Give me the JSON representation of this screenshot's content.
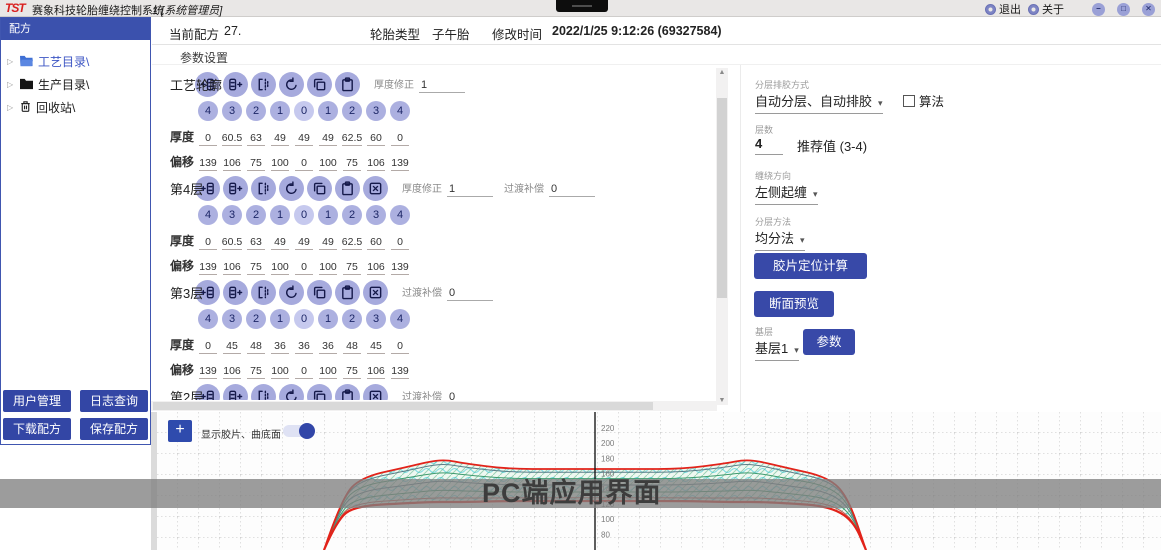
{
  "titlebar": {
    "logo": "TST",
    "title": "赛象科技轮胎缠绕控制系统",
    "subtitle": "1 [系统管理员]",
    "exit_label": "退出",
    "about_label": "关于",
    "minimize": "–",
    "maximize": "□",
    "close": "✕"
  },
  "sidebar": {
    "header": "配方",
    "tree": [
      {
        "label": "工艺目录\\",
        "icon": "folder-open-icon",
        "selected": true
      },
      {
        "label": "生产目录\\",
        "icon": "folder-icon",
        "selected": false
      },
      {
        "label": "回收站\\",
        "icon": "trash-icon",
        "selected": false
      }
    ],
    "buttons": [
      "用户管理",
      "日志查询",
      "下载配方",
      "保存配方"
    ]
  },
  "header": {
    "recipe_label": "当前配方",
    "recipe_value": "27.",
    "tire_type_label": "轮胎类型",
    "tire_type_value": "子午胎",
    "modified_label": "修改时间",
    "modified_value": "2022/1/25 9:12:26 (69327584)"
  },
  "params": {
    "section_title": "参数设置",
    "indices": [
      "4",
      "3",
      "2",
      "1",
      "0",
      "1",
      "2",
      "3",
      "4"
    ],
    "groups": [
      {
        "name": "工艺轮廓",
        "tools": [
          "insert-left",
          "insert-right",
          "mirror",
          "rotate",
          "copy",
          "paste"
        ],
        "fields": [
          {
            "label": "厚度修正",
            "value": "1"
          }
        ],
        "rows": [
          {
            "label": "厚度",
            "values": [
              "0",
              "60.5",
              "63",
              "49",
              "49",
              "49",
              "62.5",
              "60",
              "0"
            ]
          },
          {
            "label": "偏移",
            "values": [
              "139",
              "106",
              "75",
              "100",
              "0",
              "100",
              "75",
              "106",
              "139"
            ]
          }
        ]
      },
      {
        "name": "第4层",
        "tools": [
          "insert-left",
          "insert-right",
          "mirror",
          "rotate",
          "copy",
          "paste",
          "delete"
        ],
        "fields": [
          {
            "label": "厚度修正",
            "value": "1"
          },
          {
            "label": "过渡补偿",
            "value": "0"
          }
        ],
        "rows": [
          {
            "label": "厚度",
            "values": [
              "0",
              "60.5",
              "63",
              "49",
              "49",
              "49",
              "62.5",
              "60",
              "0"
            ]
          },
          {
            "label": "偏移",
            "values": [
              "139",
              "106",
              "75",
              "100",
              "0",
              "100",
              "75",
              "106",
              "139"
            ]
          }
        ]
      },
      {
        "name": "第3层",
        "tools": [
          "insert-left",
          "insert-right",
          "mirror",
          "rotate",
          "copy",
          "paste",
          "delete"
        ],
        "fields": [
          {
            "label": "过渡补偿",
            "value": "0"
          }
        ],
        "rows": [
          {
            "label": "厚度",
            "values": [
              "0",
              "45",
              "48",
              "36",
              "36",
              "36",
              "48",
              "45",
              "0"
            ]
          },
          {
            "label": "偏移",
            "values": [
              "139",
              "106",
              "75",
              "100",
              "0",
              "100",
              "75",
              "106",
              "139"
            ]
          }
        ]
      },
      {
        "name": "第2层",
        "tools": [
          "insert-left",
          "insert-right",
          "mirror",
          "rotate",
          "copy",
          "paste",
          "delete"
        ],
        "fields": [
          {
            "label": "过渡补偿",
            "value": "0"
          }
        ],
        "rows": []
      }
    ]
  },
  "right_panel": {
    "layer_mode_label": "分层排胶方式",
    "layer_mode_value": "自动分层、自动排胶",
    "algorithm_label": "算法",
    "algorithm_checked": false,
    "layer_count_label": "层数",
    "layer_count_value": "4",
    "recommend_text": "推荐值 (3-4)",
    "direction_label": "缠绕方向",
    "direction_value": "左侧起缠",
    "method_label": "分层方法",
    "method_value": "均分法",
    "calc_button": "胶片定位计算",
    "preview_button": "断面预览",
    "base_label": "基层",
    "base_value": "基层1",
    "params_button": "参数"
  },
  "chart": {
    "add_button": "+",
    "toggle_label": "显示胶片、曲底面",
    "toggle_on": true,
    "watermark": "PC端应用界面",
    "axis": {
      "labels": [
        "220",
        "200",
        "180",
        "160",
        "140",
        "120",
        "100",
        "80"
      ],
      "y0": 19,
      "dy": 15.2,
      "x": 438
    },
    "colors": {
      "outline": "#e2231a",
      "layer_a": "#5a7d88",
      "layer_b": "#3f9b6e",
      "layer_c": "#c4564d"
    },
    "profile": {
      "top": [
        [
          167,
          138
        ],
        [
          185,
          85
        ],
        [
          205,
          65
        ],
        [
          250,
          55
        ],
        [
          275,
          49
        ],
        [
          290,
          48
        ],
        [
          305,
          51
        ],
        [
          350,
          57
        ],
        [
          400,
          57
        ],
        [
          438,
          57
        ],
        [
          476,
          57
        ],
        [
          526,
          57
        ],
        [
          571,
          51
        ],
        [
          586,
          48
        ],
        [
          601,
          49
        ],
        [
          626,
          55
        ],
        [
          671,
          65
        ],
        [
          691,
          85
        ],
        [
          709,
          138
        ]
      ],
      "bottom": [
        [
          167,
          138
        ],
        [
          180,
          108
        ],
        [
          198,
          94
        ],
        [
          252,
          91
        ],
        [
          277,
          90
        ],
        [
          292,
          90
        ],
        [
          307,
          90
        ],
        [
          352,
          89
        ],
        [
          400,
          89
        ],
        [
          438,
          89
        ],
        [
          476,
          89
        ],
        [
          526,
          89
        ],
        [
          571,
          90
        ],
        [
          586,
          90
        ],
        [
          601,
          90
        ],
        [
          626,
          91
        ],
        [
          671,
          94
        ],
        [
          696,
          108
        ],
        [
          709,
          138
        ]
      ],
      "layer_ts": [
        0.1,
        0.3,
        0.5,
        0.72,
        0.9
      ]
    }
  }
}
